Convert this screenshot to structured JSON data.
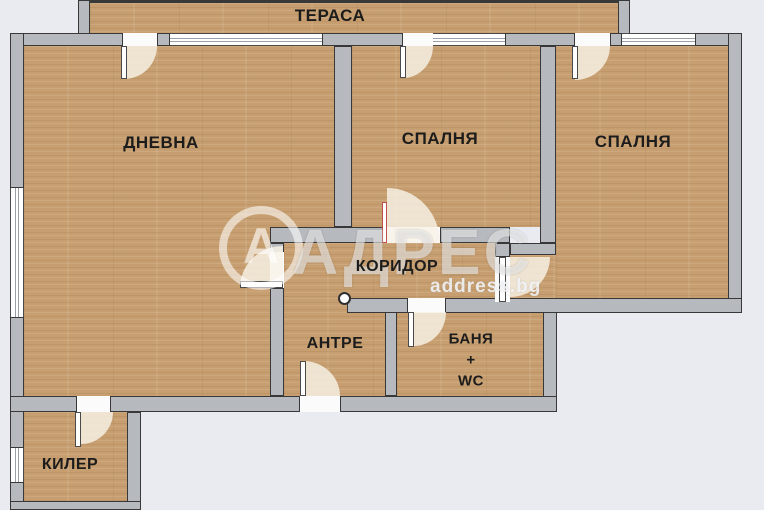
{
  "palette": {
    "background": "#e9ebf1",
    "wall": "#b6babe",
    "wall_outline": "#383838",
    "floor_base": "#c79e6f",
    "label_color": "#1c1c1c",
    "accent_door": "#c0504d"
  },
  "rooms": {
    "terrace": {
      "label": "ТЕРАСА"
    },
    "living": {
      "label": "ДНЕВНА"
    },
    "bedroom_middle": {
      "label": "СПАЛНЯ"
    },
    "bedroom_right": {
      "label": "СПАЛНЯ"
    },
    "corridor": {
      "label": "КОРИДОР"
    },
    "entry": {
      "label": "АНТРЕ"
    },
    "bathroom": {
      "line1": "БАНЯ",
      "line2": "+",
      "line3": "WC"
    },
    "pantry": {
      "label": "КИЛЕР"
    }
  },
  "watermark": {
    "logo_letter": "А",
    "brand": "АДРЕС",
    "domain": "address.bg"
  }
}
